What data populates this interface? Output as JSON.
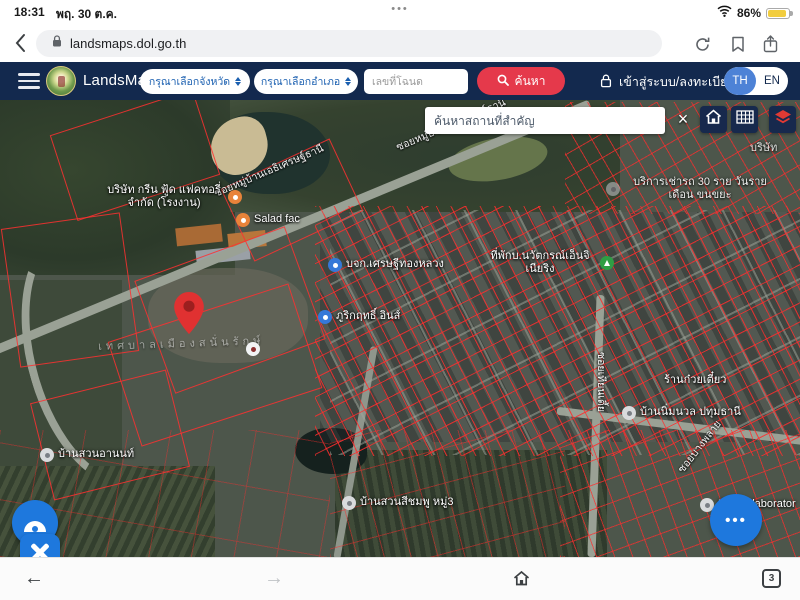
{
  "status_bar": {
    "time": "18:31",
    "date": "พฤ. 30 ต.ค.",
    "multitask_dots": "•••",
    "battery_percent": "86%"
  },
  "browser_top": {
    "url": "landsmaps.dol.go.th"
  },
  "header": {
    "app_name": "LandsMaps",
    "province_placeholder": "กรุณาเลือกจังหวัด",
    "district_placeholder": "กรุณาเลือกอำเภอ",
    "deed_placeholder": "เลขที่โฉนด",
    "search_button": "ค้นหา",
    "login_label": "เข้าสู่ระบบ/ลงทะเบียน",
    "lang_th": "TH",
    "lang_en": "EN"
  },
  "map_controls": {
    "search_placeholder": "ค้นหาสถานที่สำคัญ",
    "close_label": "×",
    "more_dots": "•••"
  },
  "map_labels": {
    "factory": "บริษัท กรีน ฟู้ด แฟคทอรี่ จำกัด (โรงงาน)",
    "salad": "Salad fac",
    "company_gold": "บจก.เศรษฐีทองหลวง",
    "engineering": "ที่พักบ.นวัตกรณ์เอ็นจิเนียริง",
    "inn": "ภูริกฤทธิ์ อินส์",
    "rental": "บริการเช่ารถ 30 ราย วันรายเดือน ขนขยะ",
    "anon_garden": "บ้านสวนอานนท์",
    "nimnuan": "บ้านนิ่มนวล ปทุมธานี",
    "noodle": "ร้านก๋วยเตี๋ยว",
    "pink_garden": "บ้านสวนสีชมพู หมู่3",
    "rasita": "Rasita laborator",
    "company_partial": "บริษัท",
    "municipality": "เทศบาลเมืองสนั่นรักษ์",
    "road_estate_1": "ซอยหมู่บ้านเอธิเศรษฐ์ธานี",
    "road_estate_2": "ซอยหมู่บ้านเอธิเศรษฐ์ธานี",
    "road_tian": "ซอยเทียนเตี้ย",
    "road_plai": "ซอยบางพลาย"
  },
  "bottom_bar": {
    "back": "←",
    "forward": "→",
    "tab_count": "3"
  },
  "colors": {
    "header_bg": "#13294e",
    "accent_red": "#e5394b",
    "lang_active_blue": "#4d82d6",
    "fab_blue": "#1e78dd",
    "parcel_red": "#ff2d2d",
    "battery_yellow": "#f2cd3e"
  }
}
